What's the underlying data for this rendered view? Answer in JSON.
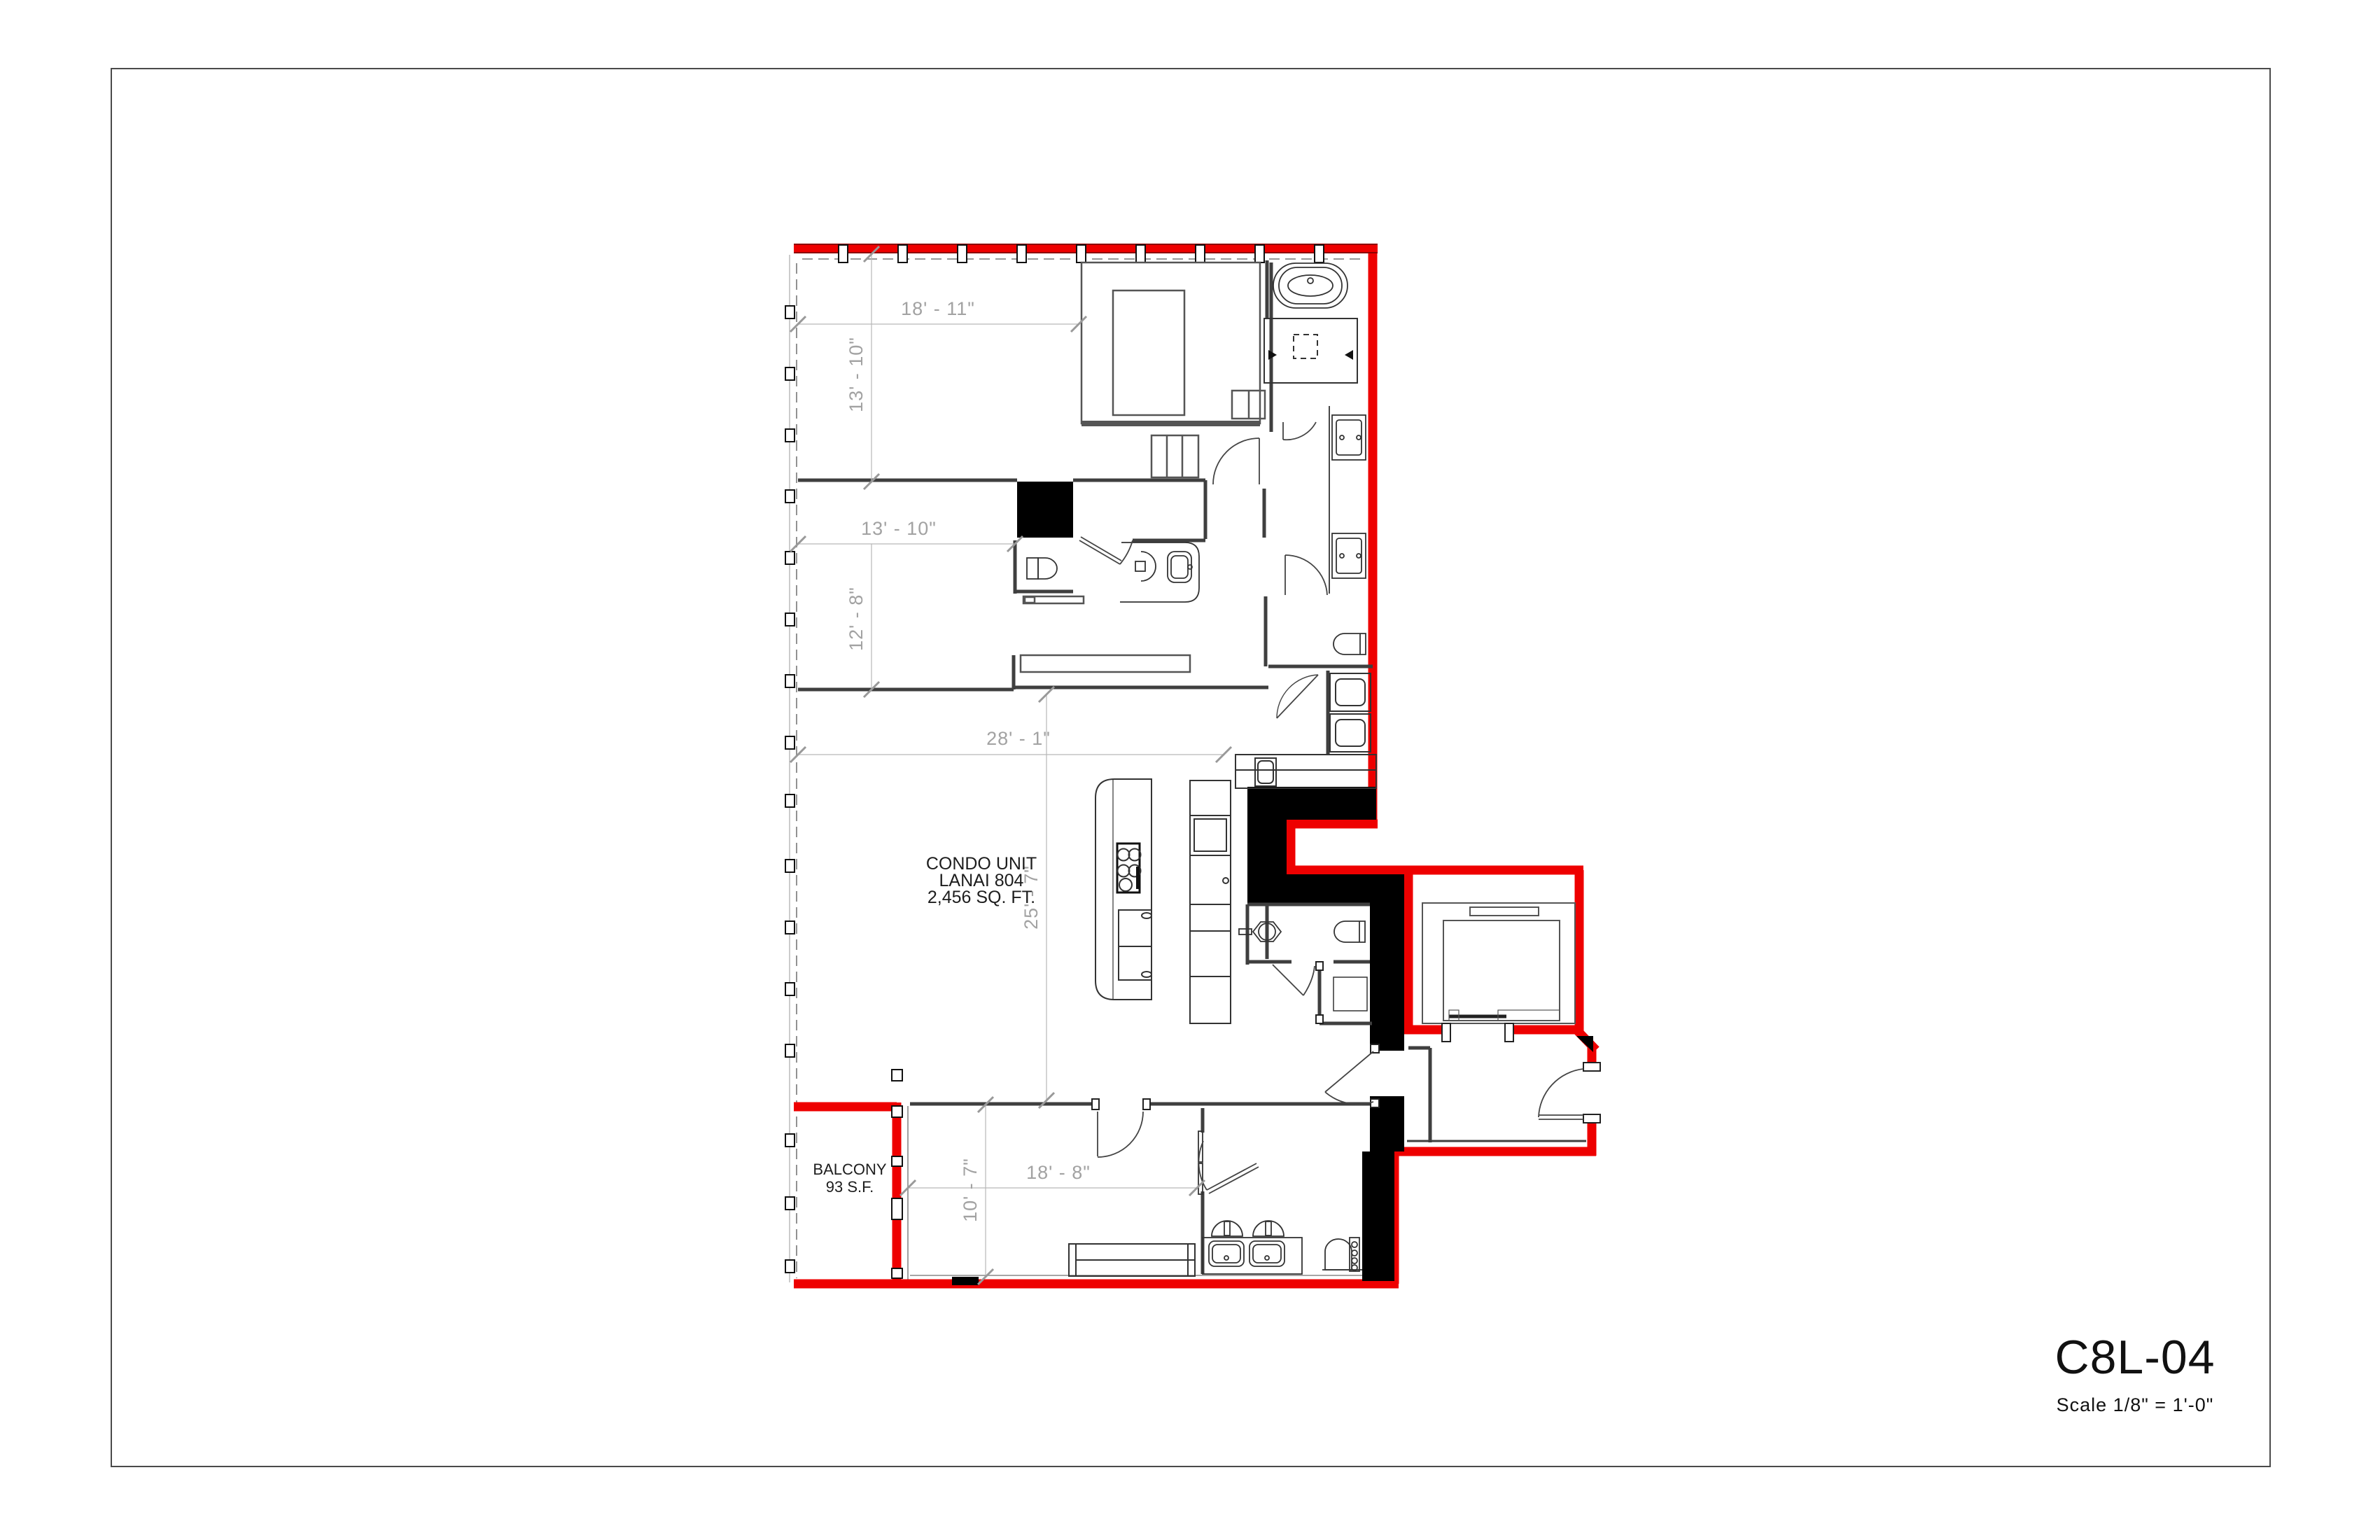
{
  "page": {
    "title": "C8L-04",
    "scale_label": "Scale  1/8\" = 1'-0\""
  },
  "plan": {
    "unit_label": {
      "line1": "CONDO UNIT",
      "line2": "LANAI 804",
      "line3": "2,456 SQ. FT."
    },
    "balcony_label": {
      "line1": "BALCONY",
      "line2": "93 S.F."
    },
    "dimensions": {
      "top_width": "18' - 11\"",
      "bed1_height": "13' - 10\"",
      "bed1_width": "13' - 10\"",
      "living_height": "12' - 8\"",
      "living_width": "28' - 1\"",
      "great_room_height": "25' - 7\"",
      "bed2_height": "10' - 7\"",
      "bed2_width": "18' - 8\""
    },
    "colors": {
      "unit_boundary": "#ee0000",
      "boundary_edge": "#8e0000",
      "structural_poche": "#000000",
      "interior_wall": "#3f3f3f",
      "dimension_line": "#b8b8b8",
      "dimension_text": "#a2a2a2"
    }
  }
}
